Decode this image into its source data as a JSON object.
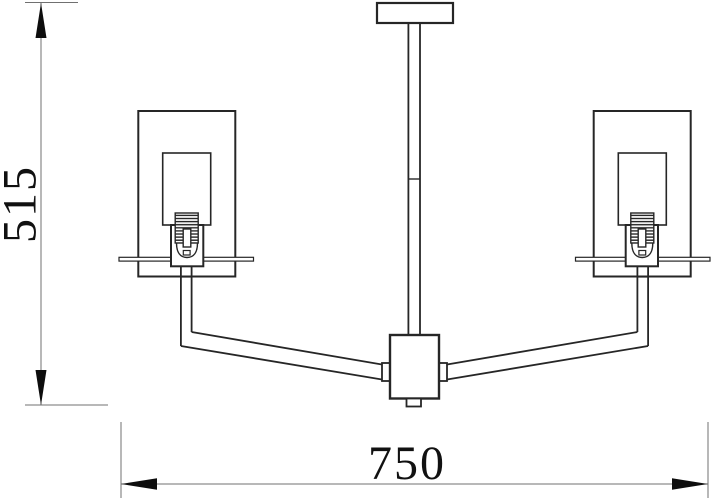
{
  "drawing": {
    "kind": "technical-line-drawing",
    "subject": "two-arm chandelier front elevation",
    "background_color": "#ffffff",
    "outline_color": "#262626",
    "dimension_line_color": "#707070",
    "arrow_color": "#0d0d0d",
    "text_color": "#111111",
    "dimensions": {
      "height": {
        "label": "515",
        "axis": "vertical",
        "position": "left"
      },
      "width": {
        "label": "750",
        "axis": "horizontal",
        "position": "bottom"
      }
    },
    "parts": {
      "canopy": "ceiling-canopy-plate",
      "rod": "drop-rod-with-coupling",
      "junction_box": "central-junction-box",
      "finial": "bottom-finial",
      "arms": "two-angled-arms",
      "shades": "rectangular-glass-shades",
      "sockets": "threaded-candle-sockets",
      "plates": "bobeche-plates"
    }
  }
}
